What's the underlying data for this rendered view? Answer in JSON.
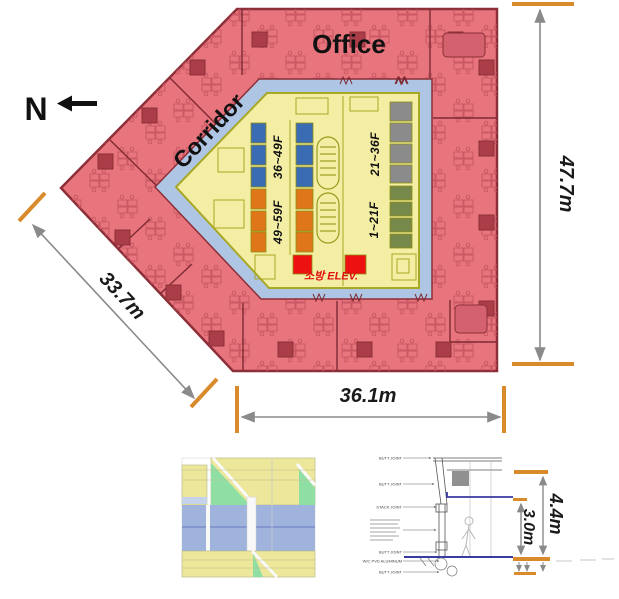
{
  "plan": {
    "office_label": "Office",
    "corridor_label": "Corridor",
    "north_label": "N",
    "fire_elevator_label": "소방 ELEV.",
    "elevator_banks": [
      {
        "label": "36~49F",
        "color": "#3a6cb4"
      },
      {
        "label": "49~59F",
        "color": "#e0761a"
      },
      {
        "label": "21~36F",
        "color": "#8b8b8b"
      },
      {
        "label": "1~21F",
        "color": "#77894a"
      }
    ]
  },
  "dimensions": {
    "height_right": "47.7m",
    "width_bottom": "36.1m",
    "diagonal_left": "33.7m",
    "floor_to_floor": "4.4m",
    "clear_height": "3.0m"
  },
  "section_labels": [
    "BUTT JOINT",
    "BUTT JOINT",
    "STACK JOINT",
    "BUTT JOINT",
    "W/C PVD ALUMINUM",
    "BUTT JOINT"
  ],
  "colors": {
    "office_fill": "#e8757d",
    "wall": "#8c2f38",
    "corridor_fill": "#aec5e3",
    "core_fill": "#f3eea3",
    "core_border": "#a8a826",
    "fire_cell": "#ee1111",
    "dimension_tick": "#d98a2b",
    "dimension_line": "#8a8a8a",
    "facade_panel": "#ece79b",
    "facade_accent": "#8fdfa5",
    "facade_glass": "#9fb3dc",
    "slab_line": "#3a3aa0",
    "fire_text": "#e01010"
  }
}
